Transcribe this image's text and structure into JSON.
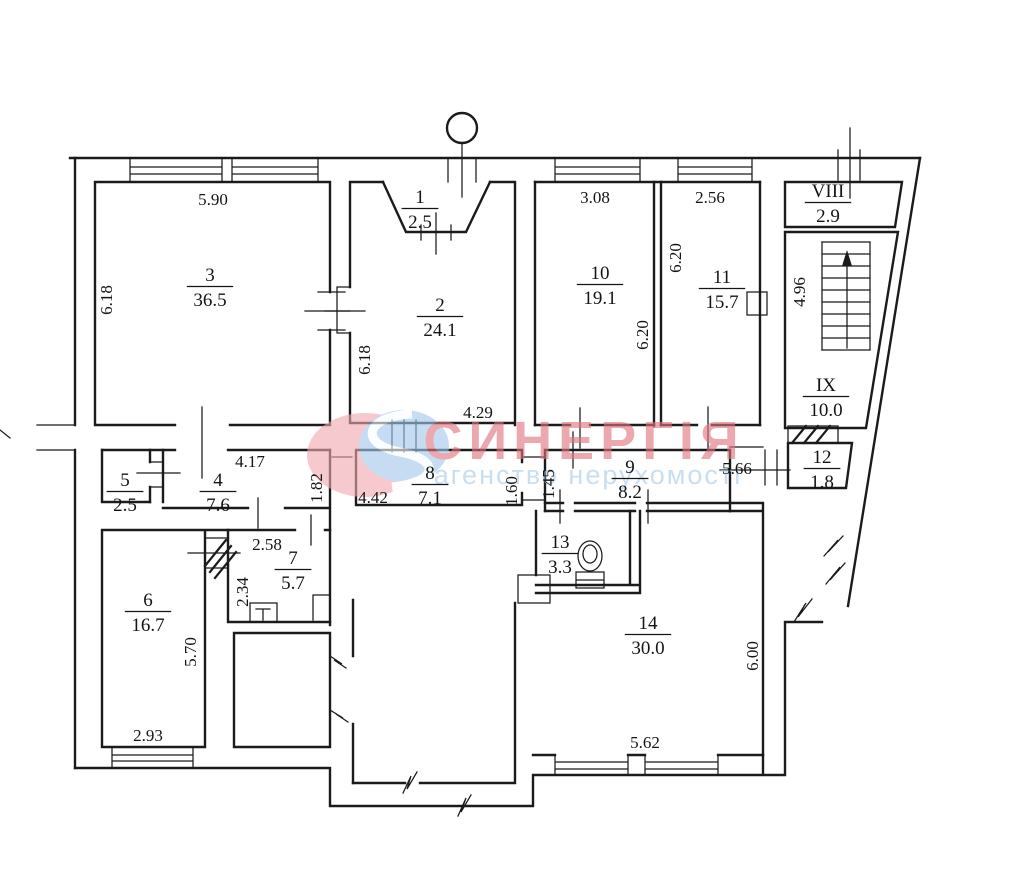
{
  "watermark": {
    "brand": "СИНЕРГІЯ",
    "tagline": "агенство нерухомості",
    "brand_color": "#e0747e",
    "tagline_color": "#a9cae8",
    "logo_pink": "#efa9b1",
    "logo_blue": "#a2c8ec"
  },
  "plan": {
    "units_note": "room number over area in m², dimensions in meters",
    "rooms": [
      {
        "number": "1",
        "area": "2.5",
        "x": 420,
        "y": 203
      },
      {
        "number": "2",
        "area": "24.1",
        "x": 440,
        "y": 311
      },
      {
        "number": "3",
        "area": "36.5",
        "x": 210,
        "y": 281
      },
      {
        "number": "4",
        "area": "7.6",
        "x": 218,
        "y": 486
      },
      {
        "number": "5",
        "area": "2.5",
        "x": 125,
        "y": 486
      },
      {
        "number": "6",
        "area": "16.7",
        "x": 148,
        "y": 606
      },
      {
        "number": "7",
        "area": "5.7",
        "x": 293,
        "y": 564
      },
      {
        "number": "8",
        "area": "7.1",
        "x": 430,
        "y": 479
      },
      {
        "number": "9",
        "area": "8.2",
        "x": 630,
        "y": 473
      },
      {
        "number": "10",
        "area": "19.1",
        "x": 600,
        "y": 279
      },
      {
        "number": "11",
        "area": "15.7",
        "x": 722,
        "y": 283
      },
      {
        "number": "12",
        "area": "1.8",
        "x": 822,
        "y": 463
      },
      {
        "number": "13",
        "area": "3.3",
        "x": 560,
        "y": 548
      },
      {
        "number": "14",
        "area": "30.0",
        "x": 648,
        "y": 629
      },
      {
        "number": "VIII",
        "area": "2.9",
        "x": 828,
        "y": 197
      },
      {
        "number": "IX",
        "area": "10.0",
        "x": 826,
        "y": 391
      }
    ],
    "dimensions": [
      {
        "text": "5.90",
        "x": 213,
        "y": 205,
        "rotate": false
      },
      {
        "text": "6.18",
        "x": 112,
        "y": 300,
        "rotate": true
      },
      {
        "text": "6.18",
        "x": 370,
        "y": 360,
        "rotate": true
      },
      {
        "text": "4.29",
        "x": 478,
        "y": 418,
        "rotate": false
      },
      {
        "text": "3.08",
        "x": 595,
        "y": 203,
        "rotate": false
      },
      {
        "text": "2.56",
        "x": 710,
        "y": 203,
        "rotate": false
      },
      {
        "text": "6.20",
        "x": 648,
        "y": 335,
        "rotate": true
      },
      {
        "text": "6.20",
        "x": 681,
        "y": 258,
        "rotate": true
      },
      {
        "text": "4.96",
        "x": 805,
        "y": 292,
        "rotate": true
      },
      {
        "text": "4.17",
        "x": 250,
        "y": 467,
        "rotate": false
      },
      {
        "text": "1.82",
        "x": 322,
        "y": 488,
        "rotate": true
      },
      {
        "text": "4.42",
        "x": 373,
        "y": 503,
        "rotate": false
      },
      {
        "text": "1.60",
        "x": 517,
        "y": 491,
        "rotate": true
      },
      {
        "text": "1.45",
        "x": 554,
        "y": 484,
        "rotate": true
      },
      {
        "text": "5.66",
        "x": 737,
        "y": 474,
        "rotate": false
      },
      {
        "text": "2.58",
        "x": 267,
        "y": 550,
        "rotate": false
      },
      {
        "text": "2.34",
        "x": 248,
        "y": 592,
        "rotate": true
      },
      {
        "text": "5.70",
        "x": 196,
        "y": 652,
        "rotate": true
      },
      {
        "text": "2.93",
        "x": 148,
        "y": 741,
        "rotate": false
      },
      {
        "text": "13",
        "x": 0,
        "y": 0,
        "rotate": false,
        "hidden": true
      },
      {
        "text": "6.00",
        "x": 758,
        "y": 656,
        "rotate": true
      },
      {
        "text": "5.62",
        "x": 645,
        "y": 748,
        "rotate": false
      }
    ]
  }
}
